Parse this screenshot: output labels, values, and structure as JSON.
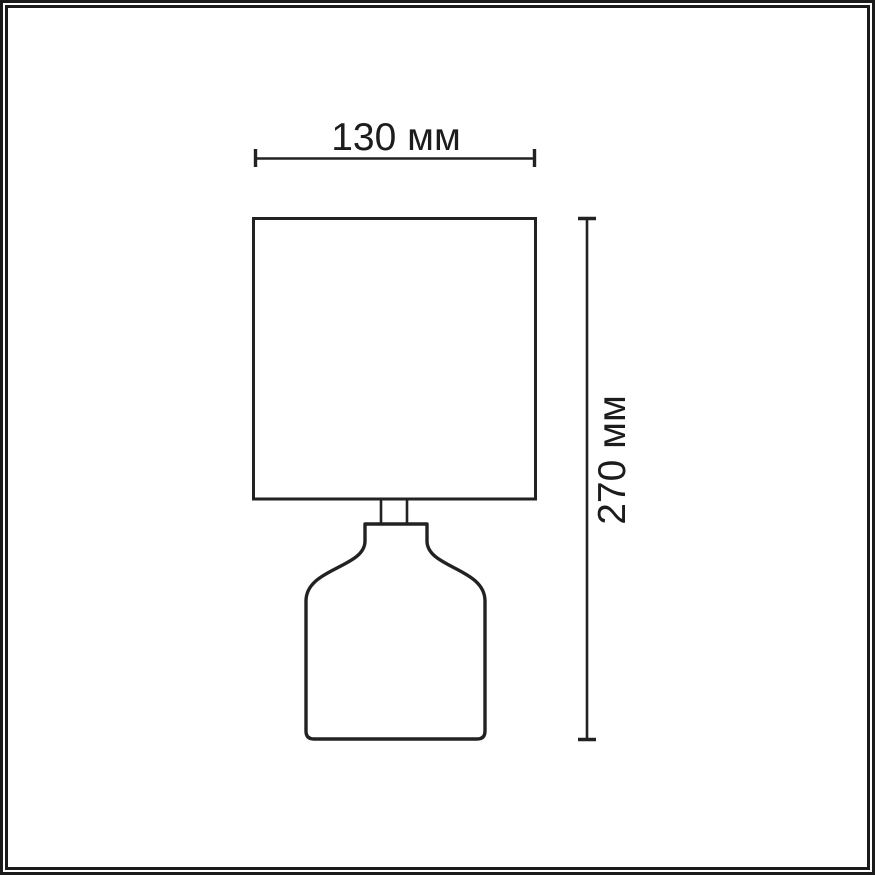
{
  "diagram": {
    "type": "product-dimension-drawing",
    "object": "table-lamp",
    "dimensions": {
      "width": {
        "label": "130 мм",
        "value": 130,
        "unit": "мм"
      },
      "height": {
        "label": "270 мм",
        "value": 270,
        "unit": "мм"
      }
    },
    "colors": {
      "line": "#222222",
      "frame": "#1b1b1b",
      "background": "#ffffff"
    }
  }
}
